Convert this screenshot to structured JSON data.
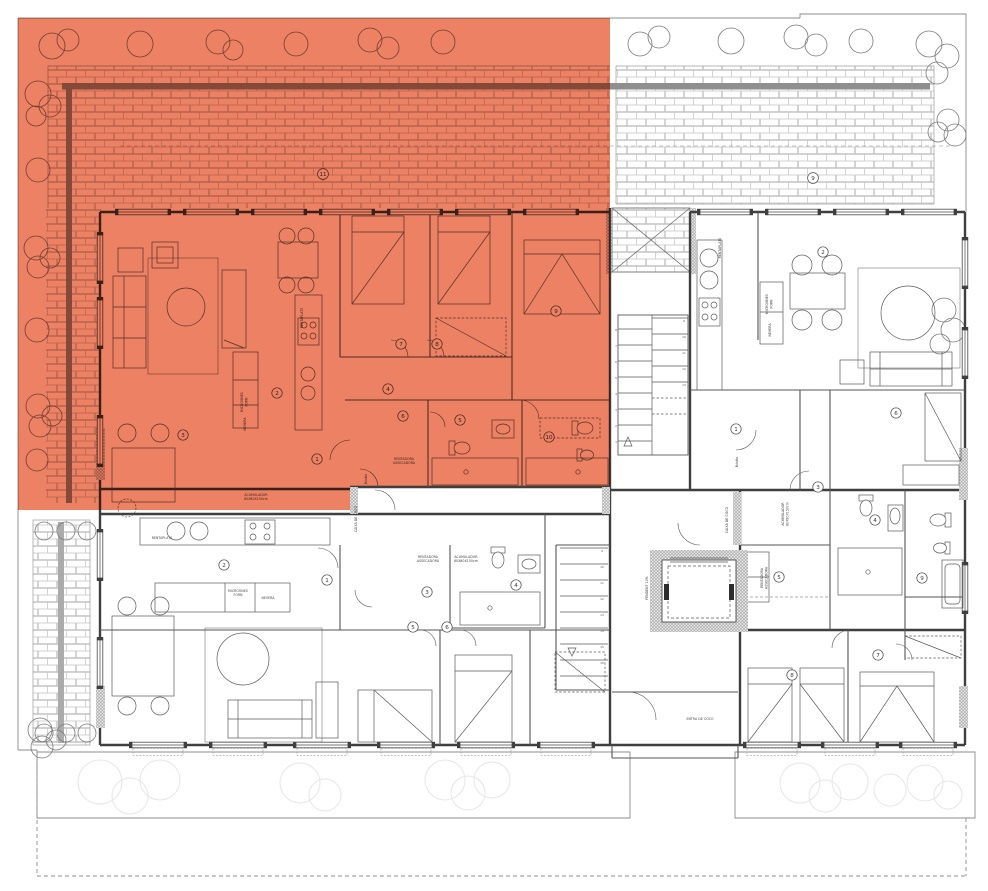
{
  "colors": {
    "highlight": "#ec8164",
    "wall": "#3f3f3f",
    "partition": "#545454",
    "furniture": "#5a5a5a",
    "brick_line": "#c3c3c3",
    "band": "#8f8f8f",
    "tree": "#7a7a7a",
    "tree_faint": "#e6e6e6",
    "dash": "#9a9a9a"
  },
  "room_markers": {
    "terrace_left": "11",
    "terrace_right": "9",
    "tl": [
      "1",
      "2",
      "3",
      "4",
      "5",
      "6",
      "7",
      "8",
      "9",
      "10"
    ],
    "tr": [
      "1",
      "2",
      "3",
      "6"
    ],
    "bl": [
      "1",
      "2",
      "3",
      "4",
      "5",
      "6"
    ],
    "br": [
      "4",
      "5",
      "7",
      "8",
      "9"
    ]
  },
  "labels": {
    "rentaplats": "RENTAPLATS",
    "microones": "MICROONES",
    "forn": "FORN",
    "nevera": "NEVERA",
    "acumulador": "ACUMULADOR",
    "acumulador_mida": "80X80X150cm",
    "rentadora": "RENTADORA",
    "assecadora": "ASSECADORA",
    "caixa_coco": "CAIXA DE COCO",
    "entrada_coco": "ENTRA DE COCO",
    "pendent": "PENDENT 10%",
    "bustia": "Bústia"
  },
  "stairs": {
    "a_left": [
      "1",
      "2",
      "3",
      "4",
      "5",
      "6",
      "7",
      "8"
    ],
    "a_right": [
      "9",
      "10",
      "11",
      "12",
      "13"
    ],
    "b_right": [
      "9",
      "10",
      "11",
      "12",
      "13",
      "14",
      "15",
      "16"
    ]
  }
}
